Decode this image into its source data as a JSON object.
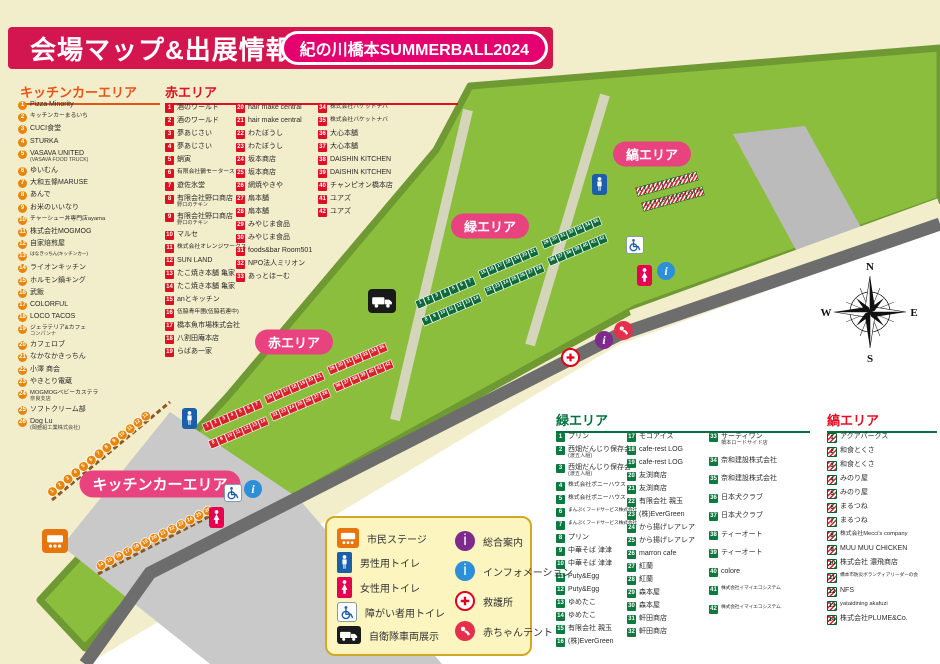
{
  "title": {
    "heading": "会場マップ&出展情報",
    "event_badge": "紀の川橋本SUMMERBALL2024"
  },
  "areas": {
    "kitchen": {
      "heading": "キッチンカーエリア",
      "items": [
        {
          "n": 1,
          "label": "Pizza Minority"
        },
        {
          "n": 2,
          "label": "キッチンカーまるいち"
        },
        {
          "n": 3,
          "label": "CUCI食堂"
        },
        {
          "n": 4,
          "label": "STURKA"
        },
        {
          "n": 5,
          "label": "VASAVA UNITED",
          "sub": "(VASAVA FOOD TRUCK)"
        },
        {
          "n": 6,
          "label": "ゆいむん"
        },
        {
          "n": 7,
          "label": "大和五條MARUSE"
        },
        {
          "n": 8,
          "label": "あんで"
        },
        {
          "n": 9,
          "label": "お米のいいなり"
        },
        {
          "n": 10,
          "label": "チャーシュー丼専門店ayama"
        },
        {
          "n": 11,
          "label": "株式会社MOGMOG"
        },
        {
          "n": 12,
          "label": "自家焙煎屋"
        },
        {
          "n": 13,
          "label": "はなきっちん(キッチンカー)"
        },
        {
          "n": 14,
          "label": "ライオンキッチン"
        },
        {
          "n": 15,
          "label": "ホルモン鍋キング"
        },
        {
          "n": 16,
          "label": "武飯"
        },
        {
          "n": 17,
          "label": "COLORFUL"
        },
        {
          "n": 18,
          "label": "LOCO TACOS"
        },
        {
          "n": 19,
          "label": "ジェラテリア&カフェ",
          "sub": "コンパンナ"
        },
        {
          "n": 20,
          "label": "カフェロブ"
        },
        {
          "n": 21,
          "label": "なかなかきっちん"
        },
        {
          "n": 22,
          "label": "小澤 商会"
        },
        {
          "n": 23,
          "label": "やきとり電蔵"
        },
        {
          "n": 24,
          "label": "MOGMOGベビーカステラ",
          "sub": "奈良支店"
        },
        {
          "n": 25,
          "label": "ソフトクリーム部"
        },
        {
          "n": 26,
          "label": "Dog Lu",
          "sub": "(岡亜鉛工業株式会社)"
        }
      ]
    },
    "red": {
      "heading": "赤エリア",
      "items": [
        {
          "n": 1,
          "label": "酒のワールド"
        },
        {
          "n": 2,
          "label": "酒のワールド"
        },
        {
          "n": 3,
          "label": "夢あじさい"
        },
        {
          "n": 4,
          "label": "夢あじさい"
        },
        {
          "n": 5,
          "label": "蛸寅"
        },
        {
          "n": 6,
          "label": "有限会社鶴モータース"
        },
        {
          "n": 7,
          "label": "遊佐氷堂"
        },
        {
          "n": 8,
          "label": "有限会社野口商店",
          "sub": "野口のチキン"
        },
        {
          "n": 9,
          "label": "有限会社野口商店",
          "sub": "野口のチキン"
        },
        {
          "n": 10,
          "label": "マルセ"
        },
        {
          "n": 11,
          "label": "株式会社オレンジワークス"
        },
        {
          "n": 12,
          "label": "SUN LAND"
        },
        {
          "n": 13,
          "label": "たこ焼き本舗 亀家"
        },
        {
          "n": 14,
          "label": "たこ焼き本舗 亀家"
        },
        {
          "n": 15,
          "label": "anとキッチン"
        },
        {
          "n": 16,
          "label": "伍脇青年團(伍脇若連中)"
        },
        {
          "n": 17,
          "label": "橋本魚市場株式会社"
        },
        {
          "n": 18,
          "label": "八割田庵本店"
        },
        {
          "n": 19,
          "label": "らばあ一家"
        },
        {
          "n": 20,
          "label": "hair make central"
        },
        {
          "n": 21,
          "label": "hair make central"
        },
        {
          "n": 22,
          "label": "わたぼうし"
        },
        {
          "n": 23,
          "label": "わたぼうし"
        },
        {
          "n": 24,
          "label": "坂本商店"
        },
        {
          "n": 25,
          "label": "坂本商店"
        },
        {
          "n": 26,
          "label": "網焼やきや"
        },
        {
          "n": 27,
          "label": "扇本舗"
        },
        {
          "n": 28,
          "label": "扇本舗"
        },
        {
          "n": 29,
          "label": "みやじま食品"
        },
        {
          "n": 30,
          "label": "みやじま食品"
        },
        {
          "n": 31,
          "label": "foods&bar Room501"
        },
        {
          "n": 32,
          "label": "NPO法人ミリオン"
        },
        {
          "n": 33,
          "label": "あっとほーむ"
        },
        {
          "n": 34,
          "label": "株式会社バケットナバ"
        },
        {
          "n": 35,
          "label": "株式会社バケットナバ"
        },
        {
          "n": 36,
          "label": "大心本舗"
        },
        {
          "n": 37,
          "label": "大心本舗"
        },
        {
          "n": 38,
          "label": "DAISHIN KITCHEN"
        },
        {
          "n": 39,
          "label": "DAISHIN KITCHEN"
        },
        {
          "n": 40,
          "label": "チャンピオン橋本店"
        },
        {
          "n": 41,
          "label": "ユアズ"
        },
        {
          "n": 42,
          "label": "ユアズ"
        }
      ]
    },
    "green": {
      "heading": "緑エリア",
      "items": [
        {
          "n": 1,
          "label": "プリン"
        },
        {
          "n": 2,
          "label": "西畑だんじり保存会",
          "sub": "(渡五人組)"
        },
        {
          "n": 3,
          "label": "西畑だんじり保存会",
          "sub": "(渡五人組)"
        },
        {
          "n": 4,
          "label": "株式会社ポニーハウス"
        },
        {
          "n": 5,
          "label": "株式会社ポニーハウス"
        },
        {
          "n": 6,
          "label": "まんぷくフードサービス株式会社"
        },
        {
          "n": 7,
          "label": "まんぷくフードサービス株式会社"
        },
        {
          "n": 8,
          "label": "プリン"
        },
        {
          "n": 9,
          "label": "中華そば 津津"
        },
        {
          "n": 10,
          "label": "中華そば 津津"
        },
        {
          "n": 11,
          "label": "Puty&Egg"
        },
        {
          "n": 12,
          "label": "Puty&Egg"
        },
        {
          "n": 13,
          "label": "ゆめたこ"
        },
        {
          "n": 14,
          "label": "ゆめたこ"
        },
        {
          "n": 15,
          "label": "有限会社 親玉"
        },
        {
          "n": 16,
          "label": "(株)EverGreen"
        },
        {
          "n": 17,
          "label": "モコアイス"
        },
        {
          "n": 18,
          "label": "cafe-rest LOG"
        },
        {
          "n": 19,
          "label": "cafe-rest LOG"
        },
        {
          "n": 20,
          "label": "友渕商店"
        },
        {
          "n": 21,
          "label": "友渕商店"
        },
        {
          "n": 22,
          "label": "有限会社 親玉"
        },
        {
          "n": 23,
          "label": "(株)EverGreen"
        },
        {
          "n": 24,
          "label": "から揚げレアレア"
        },
        {
          "n": 25,
          "label": "から揚げレアレア"
        },
        {
          "n": 26,
          "label": "marron cafe"
        },
        {
          "n": 27,
          "label": "紅蘭"
        },
        {
          "n": 28,
          "label": "紅蘭"
        },
        {
          "n": 29,
          "label": "森本屋"
        },
        {
          "n": 30,
          "label": "森本屋"
        },
        {
          "n": 31,
          "label": "軒田商店"
        },
        {
          "n": 32,
          "label": "軒田商店"
        },
        {
          "n": 33,
          "label": "サーティワン",
          "sub": "橋本ロードサイド店"
        },
        {
          "n": 34,
          "label": "奈和建設株式会社"
        },
        {
          "n": 35,
          "label": "奈和建設株式会社"
        },
        {
          "n": 36,
          "label": "日本犬クラブ"
        },
        {
          "n": 37,
          "label": "日本犬クラブ"
        },
        {
          "n": 38,
          "label": "ティーオート"
        },
        {
          "n": 39,
          "label": "ティーオート"
        },
        {
          "n": 40,
          "label": "colore"
        },
        {
          "n": 41,
          "label": "株式会社イマイエコシステム"
        },
        {
          "n": 42,
          "label": "株式会社イマイエコシステム"
        }
      ]
    },
    "stripe": {
      "heading": "縞エリア",
      "items": [
        {
          "n": 1,
          "label": "アクアパークス"
        },
        {
          "n": 2,
          "label": "和食とくさ"
        },
        {
          "n": 3,
          "label": "和食とくさ"
        },
        {
          "n": 4,
          "label": "みのり屋"
        },
        {
          "n": 5,
          "label": "みのり屋"
        },
        {
          "n": 6,
          "label": "まるつね"
        },
        {
          "n": 7,
          "label": "まるつね"
        },
        {
          "n": 8,
          "label": "株式会社Mecci's company"
        },
        {
          "n": 9,
          "label": "MUU MUU CHICKEN"
        },
        {
          "n": 10,
          "label": "株式会社 濃飛商店"
        },
        {
          "n": 11,
          "label": "橋本市防災ボランティアリーダーの会"
        },
        {
          "n": 12,
          "label": "NFS"
        },
        {
          "n": 13,
          "label": "yataidining akafuzi"
        },
        {
          "n": 14,
          "label": "株式会社PLUME&Co."
        }
      ]
    }
  },
  "map": {
    "labels": {
      "red": "赤エリア",
      "green": "緑エリア",
      "stripe": "縞エリア",
      "kitchen": "キッチンカーエリア"
    },
    "compass": {
      "n": "N",
      "e": "E",
      "s": "S",
      "w": "W"
    },
    "stalls": {
      "red": [
        [
          1,
          7
        ],
        [
          15,
          21
        ],
        [
          29,
          35
        ],
        [
          8,
          14
        ],
        [
          22,
          28
        ],
        [
          36,
          42
        ]
      ],
      "green": [
        [
          1,
          7
        ],
        [
          15,
          21
        ],
        [
          29,
          35
        ],
        [
          8,
          14
        ],
        [
          22,
          28
        ],
        [
          36,
          42
        ]
      ],
      "stripe": [
        [
          1,
          7
        ],
        [
          8,
          14
        ]
      ],
      "kitchen": [
        [
          1,
          13
        ],
        [
          14,
          26
        ]
      ]
    }
  },
  "legend": {
    "left": [
      {
        "icon": "stage-icon",
        "label": "市民ステージ"
      },
      {
        "icon": "male-toilet-icon",
        "label": "男性用トイレ"
      },
      {
        "icon": "female-toilet-icon",
        "label": "女性用トイレ"
      },
      {
        "icon": "wheelchair-toilet-icon",
        "label": "障がい者用トイレ"
      },
      {
        "icon": "truck-icon",
        "label": "自衛隊車両展示"
      }
    ],
    "right": [
      {
        "icon": "info-purple-icon",
        "label": "総合案内"
      },
      {
        "icon": "info-blue-icon",
        "label": "インフォメーション"
      },
      {
        "icon": "first-aid-icon",
        "label": "救護所"
      },
      {
        "icon": "baby-tent-icon",
        "label": "赤ちゃんテント"
      }
    ]
  },
  "colors": {
    "page_beige": "#f2edca",
    "banner_red": "#d31650",
    "badge_pink": "#e4006f",
    "pill_pink": "#e8437f",
    "area_red": "#dd1123",
    "area_green": "#00703c",
    "kitchen_orange": "#e8860b",
    "field_green": "#8cbe3e",
    "field_rim": "#6f9a33",
    "road_gray": "#6d6d6d",
    "parking_gray": "#bbbbbb",
    "kitchen_gray": "#c9c9c9"
  }
}
